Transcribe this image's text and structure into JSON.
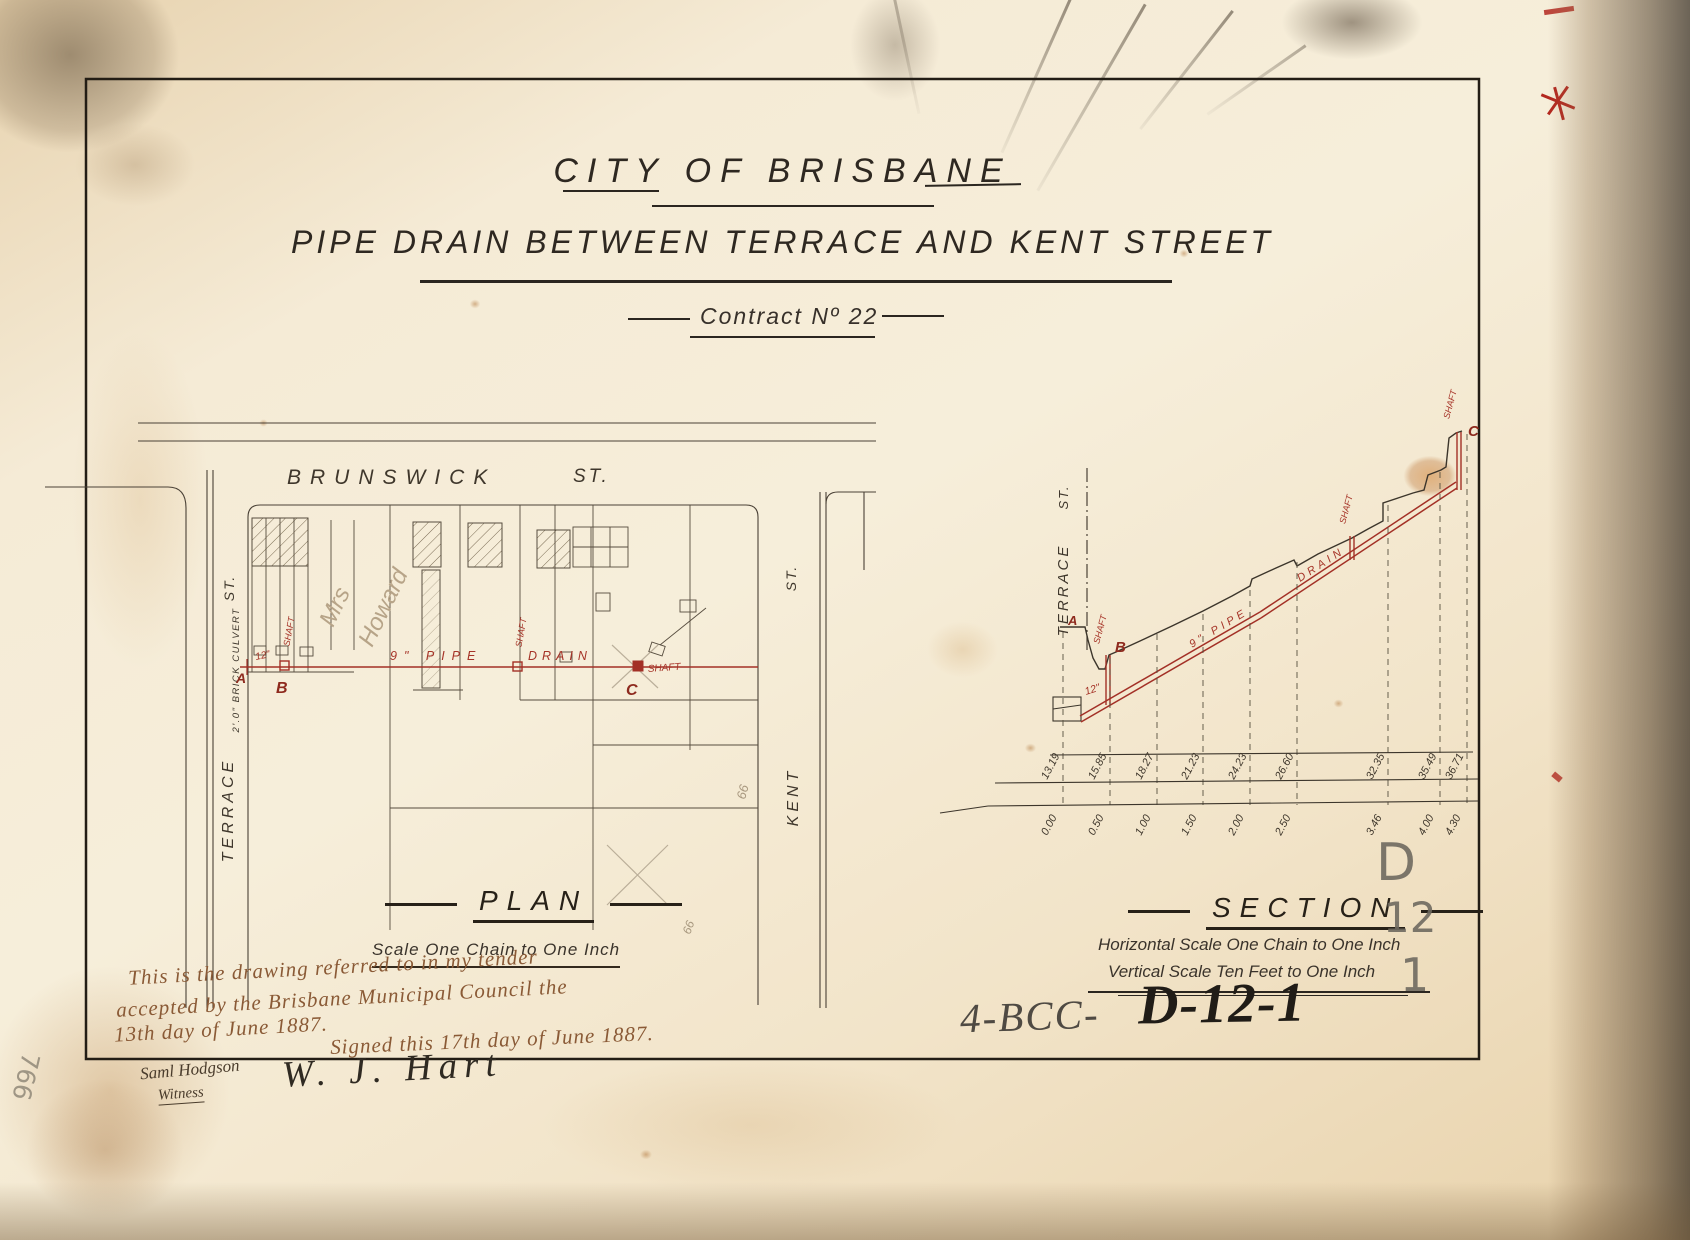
{
  "document": {
    "title_city": "CITY OF BRISBANE",
    "title_subject": "PIPE DRAIN BETWEEN TERRACE AND KENT STREET",
    "title_contract": "Contract Nº 22"
  },
  "plan": {
    "caption": "PLAN",
    "scale_note": "Scale One Chain to One Inch",
    "street_brunswick": "BRUNSWICK",
    "street_brunswick_st": "ST.",
    "street_terrace": "TERRACE",
    "street_terrace_st": "ST.",
    "street_kent": "KENT",
    "street_kent_st": "ST.",
    "culvert_note": "2'.0\" BRICK CULVERT",
    "pipe_label": "9\" PIPE",
    "drain_label": "DRAIN",
    "shaft_label": "SHAFT",
    "point_a": "A",
    "point_b": "B",
    "point_c": "C",
    "pipe_size_note": "12\"",
    "owner_note_1": "Mrs",
    "owner_note_2": "Howard",
    "lot_number": "66"
  },
  "section": {
    "caption": "SECTION",
    "scale_horizontal": "Horizontal Scale One Chain to One Inch",
    "scale_vertical": "Vertical Scale Ten Feet to One Inch",
    "street_terrace": "TERRACE",
    "street_terrace_st": "ST.",
    "pipe_label": "9\" PIPE",
    "drain_label": "DRAIN",
    "shaft_label": "SHAFT",
    "point_a": "A",
    "point_b": "B",
    "point_c": "C",
    "pipe_size_note": "12\"",
    "levels": [
      "13.19",
      "15.85",
      "18.27",
      "21.23",
      "24.23",
      "26.60",
      "32.35",
      "35.49",
      "36.71"
    ],
    "chainages": [
      "0.00",
      "0.50",
      "1.00",
      "1.50",
      "2.00",
      "2.50",
      "3.46",
      "4.00",
      "4.30"
    ]
  },
  "annotations": {
    "tender_line1": "This is the drawing referred to in my tender",
    "tender_line2": "accepted by the Brisbane Municipal Council the",
    "tender_line3": "13th day of June 1887.",
    "signed_line": "Signed this 17th day of June 1887.",
    "witness_signature": "Saml Hodgson",
    "witness_label": "Witness",
    "contractor_signature": "W. J. Hart",
    "edge_scribble": "766"
  },
  "stamps": {
    "ref_prefix": "4-BCC-",
    "ref_code": "D-12-1",
    "pencil_line1": "D",
    "pencil_line2": "12",
    "pencil_line3": "1"
  },
  "colors": {
    "ink_black": "#35302a",
    "ink_red": "#a63428",
    "ink_sepia": "#8a5a36",
    "pencil_gray": "#6f6a60",
    "paper": "#f2e5cc"
  }
}
